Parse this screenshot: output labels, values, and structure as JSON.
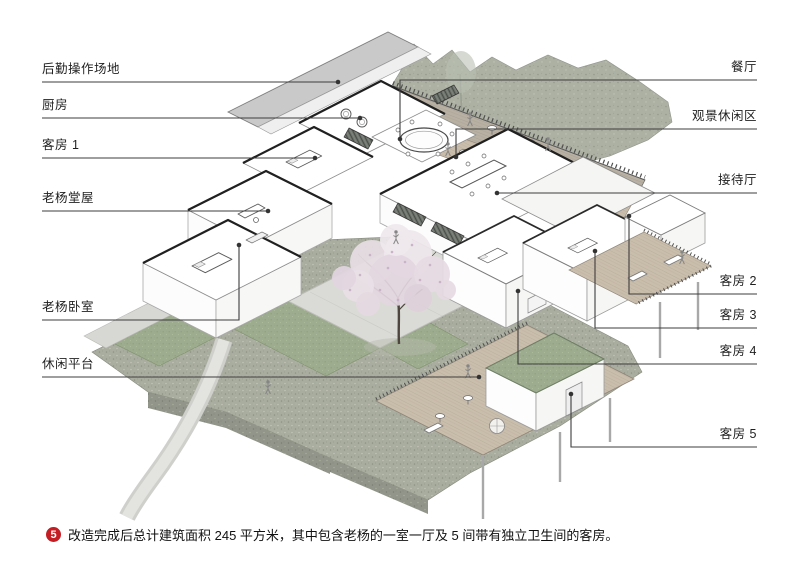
{
  "figure": {
    "badge": "5",
    "caption": "改造完成后总计建筑面积 245 平方米，其中包含老杨的一室一厅及 5 间带有独立卫生间的客房。"
  },
  "labels": {
    "left": [
      {
        "id": "back-of-house-area",
        "text": "后勤操作场地"
      },
      {
        "id": "kitchen",
        "text": "厨房"
      },
      {
        "id": "guest-room-1",
        "text": "客房 1"
      },
      {
        "id": "laoyang-hall",
        "text": "老杨堂屋"
      },
      {
        "id": "laoyang-bedroom",
        "text": "老杨卧室"
      },
      {
        "id": "leisure-platform",
        "text": "休闲平台"
      }
    ],
    "right": [
      {
        "id": "dining-hall",
        "text": "餐厅"
      },
      {
        "id": "viewing-lounge-area",
        "text": "观景休闲区"
      },
      {
        "id": "reception-hall",
        "text": "接待厅"
      },
      {
        "id": "guest-room-2",
        "text": "客房 2"
      },
      {
        "id": "guest-room-3",
        "text": "客房 3"
      },
      {
        "id": "guest-room-4",
        "text": "客房 4"
      },
      {
        "id": "guest-room-5",
        "text": "客房 5"
      }
    ]
  },
  "colors": {
    "accent_red": "#c41e24",
    "stone": "#a9ad9f",
    "grass": "#9dab8e",
    "wood_deck": "#c9bdac",
    "roof_grey": "#c9c9c9",
    "blossom": "#e9dfe6",
    "leader_line": "#3d3d3d"
  }
}
